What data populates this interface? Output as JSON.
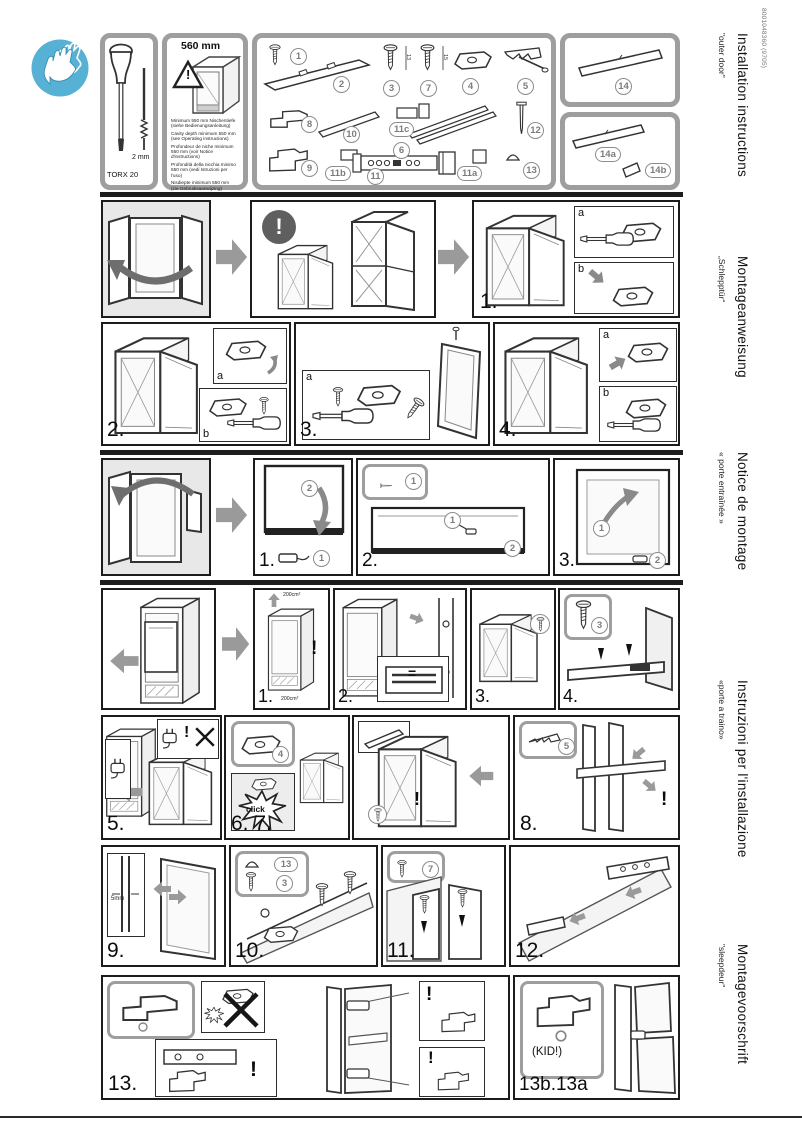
{
  "doc_code": "8001048360 (9705)",
  "languages": [
    {
      "title": "Installation instructions",
      "subtitle": "\"outer door\""
    },
    {
      "title": "Montageanweisung",
      "subtitle": "„Schlepptür“"
    },
    {
      "title": "Notice de montage",
      "subtitle": "« porte entraînée »"
    },
    {
      "title": "Instruzioni per l'installazione",
      "subtitle": "«porte a traino»"
    },
    {
      "title": "Montagevoorschrift",
      "subtitle": "\"sleepdeur\""
    }
  ],
  "tools": {
    "screwdriver_label": "TORX 20",
    "hexkey_label": "2 mm"
  },
  "cavity": {
    "width_label": "560 mm",
    "warning_mark": "!",
    "notes": [
      "Minimum 550 mm Nischentiefe (siehe Bedienungsanleitung)",
      "Cavity depth minimum 550 mm (see Operating instructions)",
      "Profondeur de niche minimum 550 mm (voir Notice d'instructions)",
      "Profondità della nicchia minimo 550 mm (vedi Istruzioni per l'uso)",
      "Nisdiepte minimum 550 mm (zie Gebruiksaanwijzing)"
    ]
  },
  "parts": {
    "p1": "1",
    "p2": "2",
    "p3": "3",
    "p3_len": "13",
    "p7": "7",
    "p7_len": "15",
    "p4": "4",
    "p5": "5",
    "p8": "8",
    "p10": "10",
    "p11c": "11c",
    "p6": "6",
    "p12": "12",
    "p9": "9",
    "p11b": "11b",
    "p11": "11",
    "p11a": "11a",
    "p13": "13",
    "p14": "14",
    "p14a": "14a",
    "p14b": "14b"
  },
  "steps": {
    "warning_mark": "!",
    "inset_a": "a",
    "inset_b": "b",
    "sec1": {
      "s1": "1.",
      "s2": "2.",
      "s3": "3.",
      "s4": "4."
    },
    "sec2": {
      "s1": "1.",
      "s2": "2.",
      "s3": "3.",
      "ref1": "1",
      "ref2": "2"
    },
    "sec3": {
      "s1": "1.",
      "s2": "2.",
      "s3": "3.",
      "s4": "4.",
      "s5": "5.",
      "s67": "6. 7.",
      "s8": "8.",
      "s9": "9.",
      "s10": "10.",
      "s11": "11.",
      "s12": "12.",
      "s13": "13.",
      "s13ba": "13b.13a",
      "vent": "200cm²",
      "equal": "=",
      "click": "click",
      "gap": "5mm",
      "kid": "(KID!)",
      "ref3": "3",
      "ref4": "4",
      "ref5": "5",
      "ref7": "7",
      "ref13": "13"
    }
  }
}
